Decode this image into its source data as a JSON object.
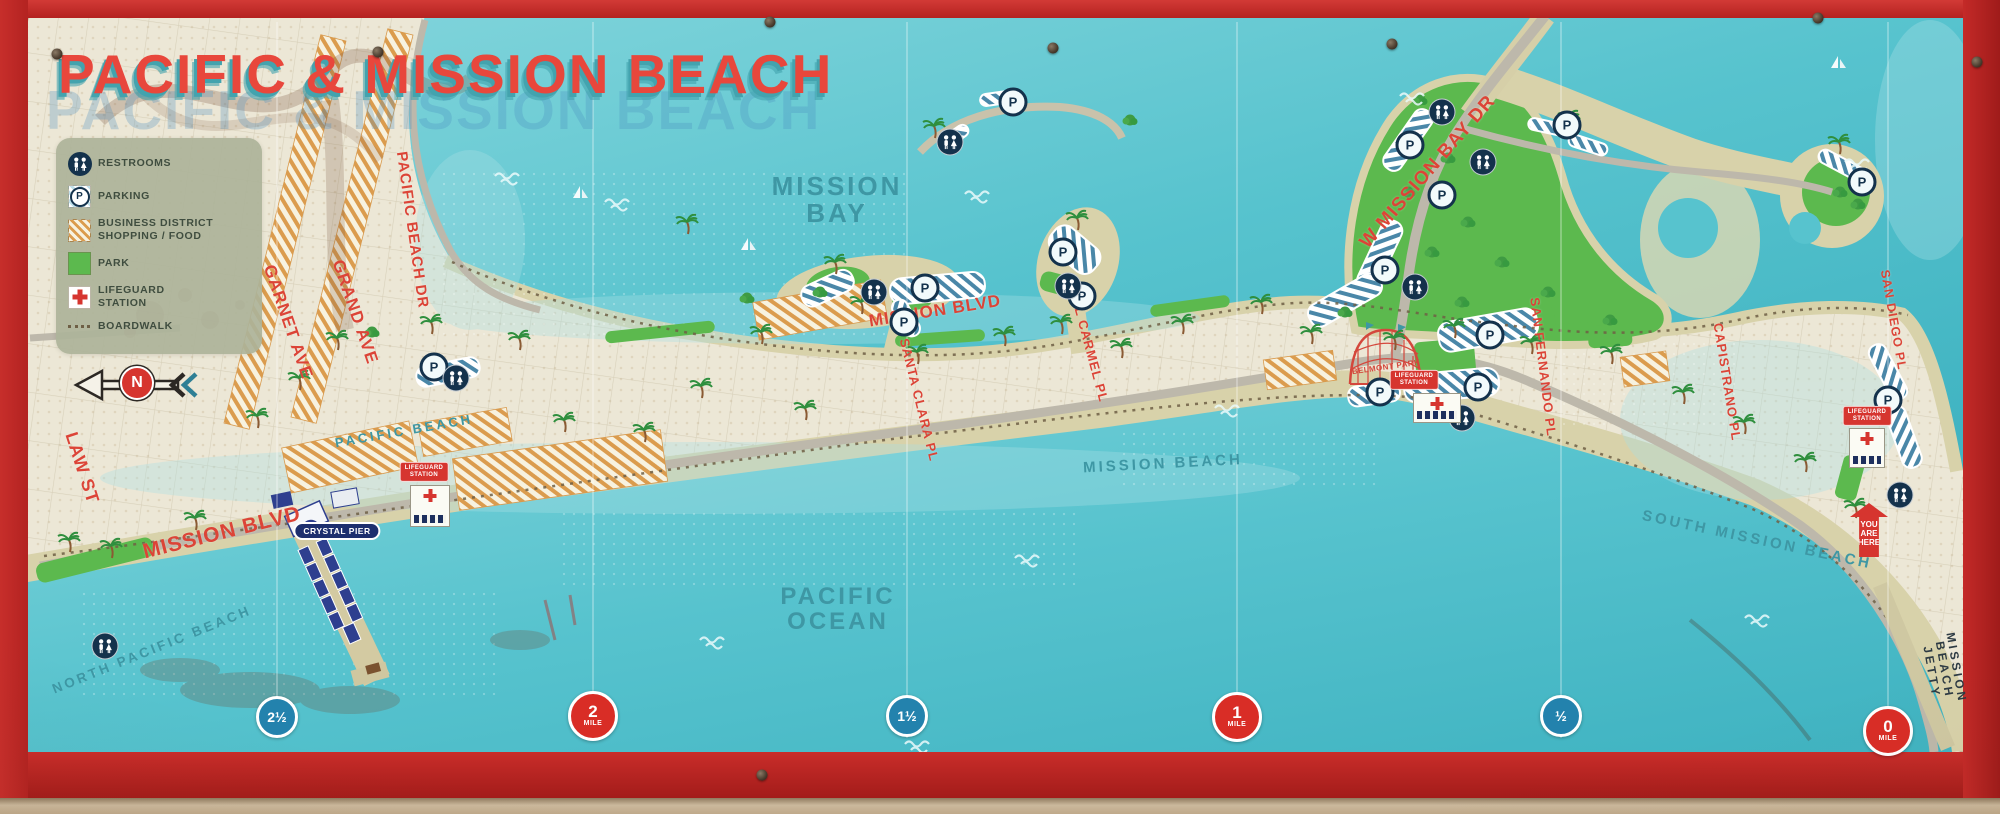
{
  "title": {
    "main": "PACIFIC & MISSION BEACH"
  },
  "legend": {
    "items": [
      {
        "icon": "restrooms-icon",
        "label": "RESTROOMS"
      },
      {
        "icon": "parking-icon",
        "label": "PARKING"
      },
      {
        "icon": "business-district-icon",
        "label": "BUSINESS DISTRICT\nSHOPPING / FOOD"
      },
      {
        "icon": "park-icon",
        "label": "PARK"
      },
      {
        "icon": "lifeguard-icon",
        "label": "LIFEGUARD\nSTATION"
      },
      {
        "icon": "boardwalk-icon",
        "label": "BOARDWALK"
      }
    ]
  },
  "compass": {
    "label": "N"
  },
  "street_labels": [
    {
      "t": "LAW ST",
      "x": 82,
      "y": 468,
      "r": 72,
      "s": 18
    },
    {
      "t": "GARNET AVE",
      "x": 288,
      "y": 322,
      "r": 71,
      "s": 17
    },
    {
      "t": "GRAND AVE",
      "x": 355,
      "y": 312,
      "r": 71,
      "s": 17
    },
    {
      "t": "PACIFIC BEACH DR",
      "x": 412,
      "y": 230,
      "r": 82,
      "s": 15
    },
    {
      "t": "MISSION BLVD",
      "x": 222,
      "y": 533,
      "r": -14,
      "s": 21
    },
    {
      "t": "SANTA CLARA PL",
      "x": 919,
      "y": 400,
      "r": 76,
      "s": 13
    },
    {
      "t": "EL CARMEL PL",
      "x": 1090,
      "y": 350,
      "r": 75,
      "s": 13
    },
    {
      "t": "MISSION BLVD",
      "x": 935,
      "y": 311,
      "r": -9,
      "s": 17
    },
    {
      "t": "W MISSION BAY DR",
      "x": 1428,
      "y": 172,
      "r": -49,
      "s": 19
    },
    {
      "t": "SAN FERNANDO PL",
      "x": 1543,
      "y": 367,
      "r": 83,
      "s": 13
    },
    {
      "t": "CAPISTRANO PL",
      "x": 1727,
      "y": 382,
      "r": 81,
      "s": 13
    },
    {
      "t": "SAN DIEGO PL",
      "x": 1893,
      "y": 320,
      "r": 80,
      "s": 12.5
    }
  ],
  "place_labels": [
    {
      "t": "MISSION\nBAY",
      "x": 837,
      "y": 200,
      "r": 0,
      "s": 26
    },
    {
      "t": "PACIFIC\nOCEAN",
      "x": 838,
      "y": 610,
      "r": 0,
      "s": 24
    },
    {
      "t": "PACIFIC BEACH",
      "x": 404,
      "y": 431,
      "r": -10,
      "s": 13
    },
    {
      "t": "NORTH PACIFIC BEACH",
      "x": 152,
      "y": 650,
      "r": -22,
      "s": 13.5
    },
    {
      "t": "MISSION BEACH",
      "x": 1163,
      "y": 464,
      "r": -3,
      "s": 15
    },
    {
      "t": "SOUTH MISSION BEACH",
      "x": 1757,
      "y": 540,
      "r": 12,
      "s": 15
    },
    {
      "t": "MISSION BEACH JETTY",
      "x": 1944,
      "y": 670,
      "r": 80,
      "s": 12,
      "c": "#2e3b44"
    }
  ],
  "badges": {
    "crystal_pier": {
      "label": "CRYSTAL PIER",
      "x": 337,
      "y": 531
    },
    "belmont_park": {
      "label": "BELMONT PARK",
      "x": 1386,
      "y": 367
    },
    "you_are_here": {
      "label": "YOU\nARE\nHERE",
      "x": 1869,
      "y": 530
    },
    "lifeguard_stations": [
      {
        "label": "LIFEGUARD\nSTATION",
        "x": 424,
        "y": 472,
        "bx": 430,
        "by": 506,
        "w": 38,
        "h": 40
      },
      {
        "label": "LIFEGUARD\nSTATION",
        "x": 1414,
        "y": 380,
        "bx": 1437,
        "by": 408,
        "w": 46,
        "h": 28
      },
      {
        "label": "LIFEGUARD\nSTATION",
        "x": 1867,
        "y": 416,
        "bx": 1867,
        "by": 448,
        "w": 34,
        "h": 38
      }
    ]
  },
  "mile_markers": [
    {
      "kind": "half",
      "label": "2½",
      "x": 277,
      "y": 717
    },
    {
      "kind": "mile",
      "number": "2",
      "unit": "MILE",
      "x": 593,
      "y": 716
    },
    {
      "kind": "half",
      "label": "1½",
      "x": 907,
      "y": 716
    },
    {
      "kind": "mile",
      "number": "1",
      "unit": "MILE",
      "x": 1237,
      "y": 717
    },
    {
      "kind": "half",
      "label": "½",
      "x": 1561,
      "y": 716
    },
    {
      "kind": "mile",
      "number": "0",
      "unit": "MILE",
      "x": 1888,
      "y": 731
    }
  ],
  "map_icons": {
    "parking_letter": "P",
    "parking": [
      [
        434,
        367
      ],
      [
        904,
        322
      ],
      [
        925,
        288
      ],
      [
        1013,
        102
      ],
      [
        1063,
        252
      ],
      [
        1082,
        296
      ],
      [
        1410,
        145
      ],
      [
        1442,
        195
      ],
      [
        1385,
        270
      ],
      [
        1490,
        335
      ],
      [
        1478,
        387
      ],
      [
        1380,
        392
      ],
      [
        1567,
        125
      ],
      [
        1862,
        182
      ],
      [
        1888,
        400
      ]
    ],
    "restrooms": [
      [
        105,
        646
      ],
      [
        456,
        378
      ],
      [
        874,
        292
      ],
      [
        950,
        142
      ],
      [
        1068,
        286
      ],
      [
        1415,
        287
      ],
      [
        1442,
        112
      ],
      [
        1483,
        162
      ],
      [
        1462,
        418
      ],
      [
        1900,
        495
      ]
    ]
  },
  "decor": {
    "seams": [
      277,
      593,
      907,
      1237,
      1561,
      1888
    ],
    "bolts": [
      [
        57,
        54
      ],
      [
        378,
        52
      ],
      [
        770,
        22
      ],
      [
        1053,
        48
      ],
      [
        1392,
        44
      ],
      [
        1818,
        18
      ],
      [
        762,
        775
      ],
      [
        1977,
        62
      ]
    ],
    "palms": [
      [
        70,
        552
      ],
      [
        112,
        558
      ],
      [
        196,
        530
      ],
      [
        258,
        428
      ],
      [
        300,
        390
      ],
      [
        338,
        350
      ],
      [
        432,
        334
      ],
      [
        520,
        350
      ],
      [
        565,
        432
      ],
      [
        645,
        442
      ],
      [
        702,
        398
      ],
      [
        762,
        344
      ],
      [
        806,
        420
      ],
      [
        862,
        314
      ],
      [
        918,
        364
      ],
      [
        1005,
        346
      ],
      [
        1062,
        334
      ],
      [
        1122,
        358
      ],
      [
        1183,
        334
      ],
      [
        1262,
        314
      ],
      [
        1312,
        344
      ],
      [
        1395,
        350
      ],
      [
        1455,
        338
      ],
      [
        1532,
        354
      ],
      [
        1612,
        364
      ],
      [
        1684,
        404
      ],
      [
        1745,
        434
      ],
      [
        1806,
        472
      ],
      [
        1856,
        518
      ],
      [
        688,
        234
      ],
      [
        836,
        274
      ],
      [
        1078,
        230
      ],
      [
        1570,
        130
      ],
      [
        1840,
        154
      ],
      [
        935,
        138
      ]
    ],
    "trees": [
      [
        1420,
        100
      ],
      [
        1448,
        158
      ],
      [
        1468,
        222
      ],
      [
        1432,
        252
      ],
      [
        1502,
        262
      ],
      [
        1548,
        292
      ],
      [
        1462,
        302
      ],
      [
        1840,
        192
      ],
      [
        1858,
        204
      ],
      [
        1408,
        192
      ],
      [
        747,
        298
      ],
      [
        820,
        292
      ],
      [
        372,
        332
      ],
      [
        1345,
        312
      ],
      [
        1610,
        320
      ],
      [
        1130,
        120
      ]
    ],
    "waves": [
      [
        495,
        176
      ],
      [
        965,
        194
      ],
      [
        1400,
        96
      ],
      [
        1845,
        162
      ],
      [
        1215,
        408
      ],
      [
        1015,
        558
      ],
      [
        905,
        744
      ],
      [
        1745,
        618
      ],
      [
        605,
        202
      ],
      [
        700,
        640
      ]
    ],
    "boats": [
      [
        580,
        198
      ],
      [
        748,
        250
      ],
      [
        1838,
        68
      ]
    ]
  },
  "colors": {
    "frame": "#c5272b",
    "land": "#ece7d6",
    "water": "#52bfca",
    "sand": "#d8d2aa",
    "park": "#5cb94e",
    "street_label": "#dc4437",
    "place_label": "#3e97a4",
    "navy": "#14324c",
    "marker_blue": "#2382ad",
    "marker_red": "#d92d26"
  }
}
